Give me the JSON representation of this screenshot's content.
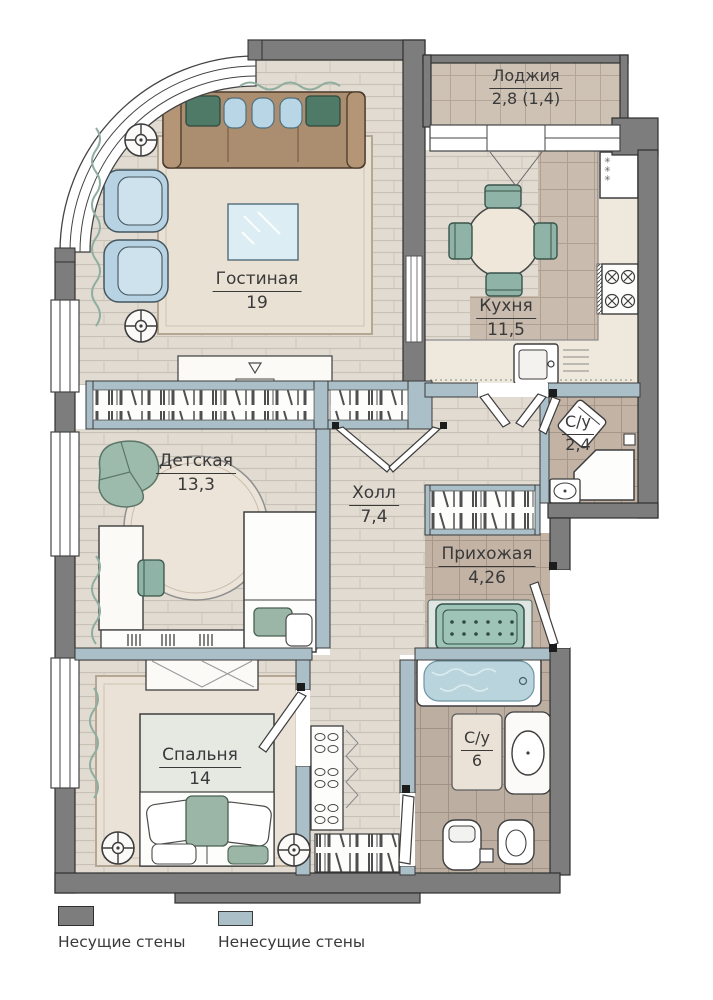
{
  "rooms": {
    "loggia": {
      "name": "Лоджия",
      "area": "2,8 (1,4)"
    },
    "living": {
      "name": "Гостиная",
      "area": "19"
    },
    "kitchen": {
      "name": "Кухня",
      "area": "11,5"
    },
    "bath_small": {
      "name": "С/у",
      "area": "2,4"
    },
    "children": {
      "name": "Детская",
      "area": "13,3"
    },
    "hall": {
      "name": "Холл",
      "area": "7,4"
    },
    "entry": {
      "name": "Прихожая",
      "area": "4,26"
    },
    "bedroom": {
      "name": "Спальня",
      "area": "14"
    },
    "bath_main": {
      "name": "С/у",
      "area": "6"
    }
  },
  "legend": {
    "items": [
      {
        "label": "Несущие стены",
        "color": "#7d7d7d"
      },
      {
        "label": "Ненесущие стены",
        "color": "#aabfc8"
      }
    ]
  },
  "icons": {
    "freezer_stars": "✳\n✳\n✳"
  },
  "colors": {
    "load_bearing_wall": "#7d7d7d",
    "partition_wall": "#aabfc8",
    "wood_floor": "#e1dbd2",
    "tile_floor": "#c2b4a6",
    "accent_green": "#9ec4b8",
    "accent_blue": "#b7d3e3",
    "sofa_brown": "#ab8d6f",
    "bath_water": "#b9d4dc"
  }
}
